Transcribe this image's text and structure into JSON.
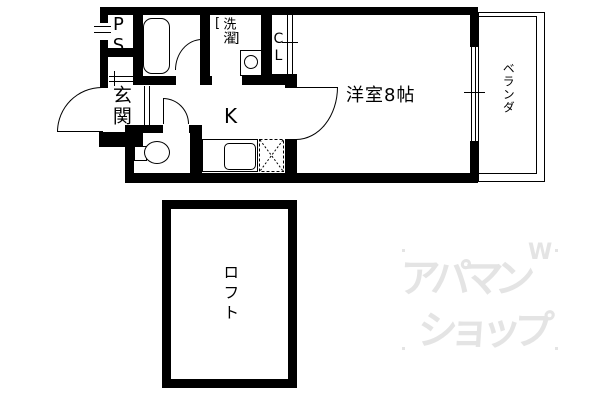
{
  "rooms": {
    "pipe_space": {
      "label": "PS"
    },
    "entrance": {
      "label": "玄関"
    },
    "laundry": {
      "label": "洗濯",
      "bracket_open": "[",
      "bracket_close": "]"
    },
    "closet": {
      "label": "CL"
    },
    "kitchen": {
      "label": "K"
    },
    "western_room": {
      "label": "洋室8帖"
    },
    "veranda": {
      "label": "ベランダ"
    },
    "loft": {
      "label": "ロフト"
    }
  },
  "watermark": {
    "line1": "アパマン",
    "line2": "ショップ",
    "mark": "W",
    "color": "#e4e4e4"
  },
  "colors": {
    "wall": "#000000",
    "floor": "#ffffff"
  }
}
